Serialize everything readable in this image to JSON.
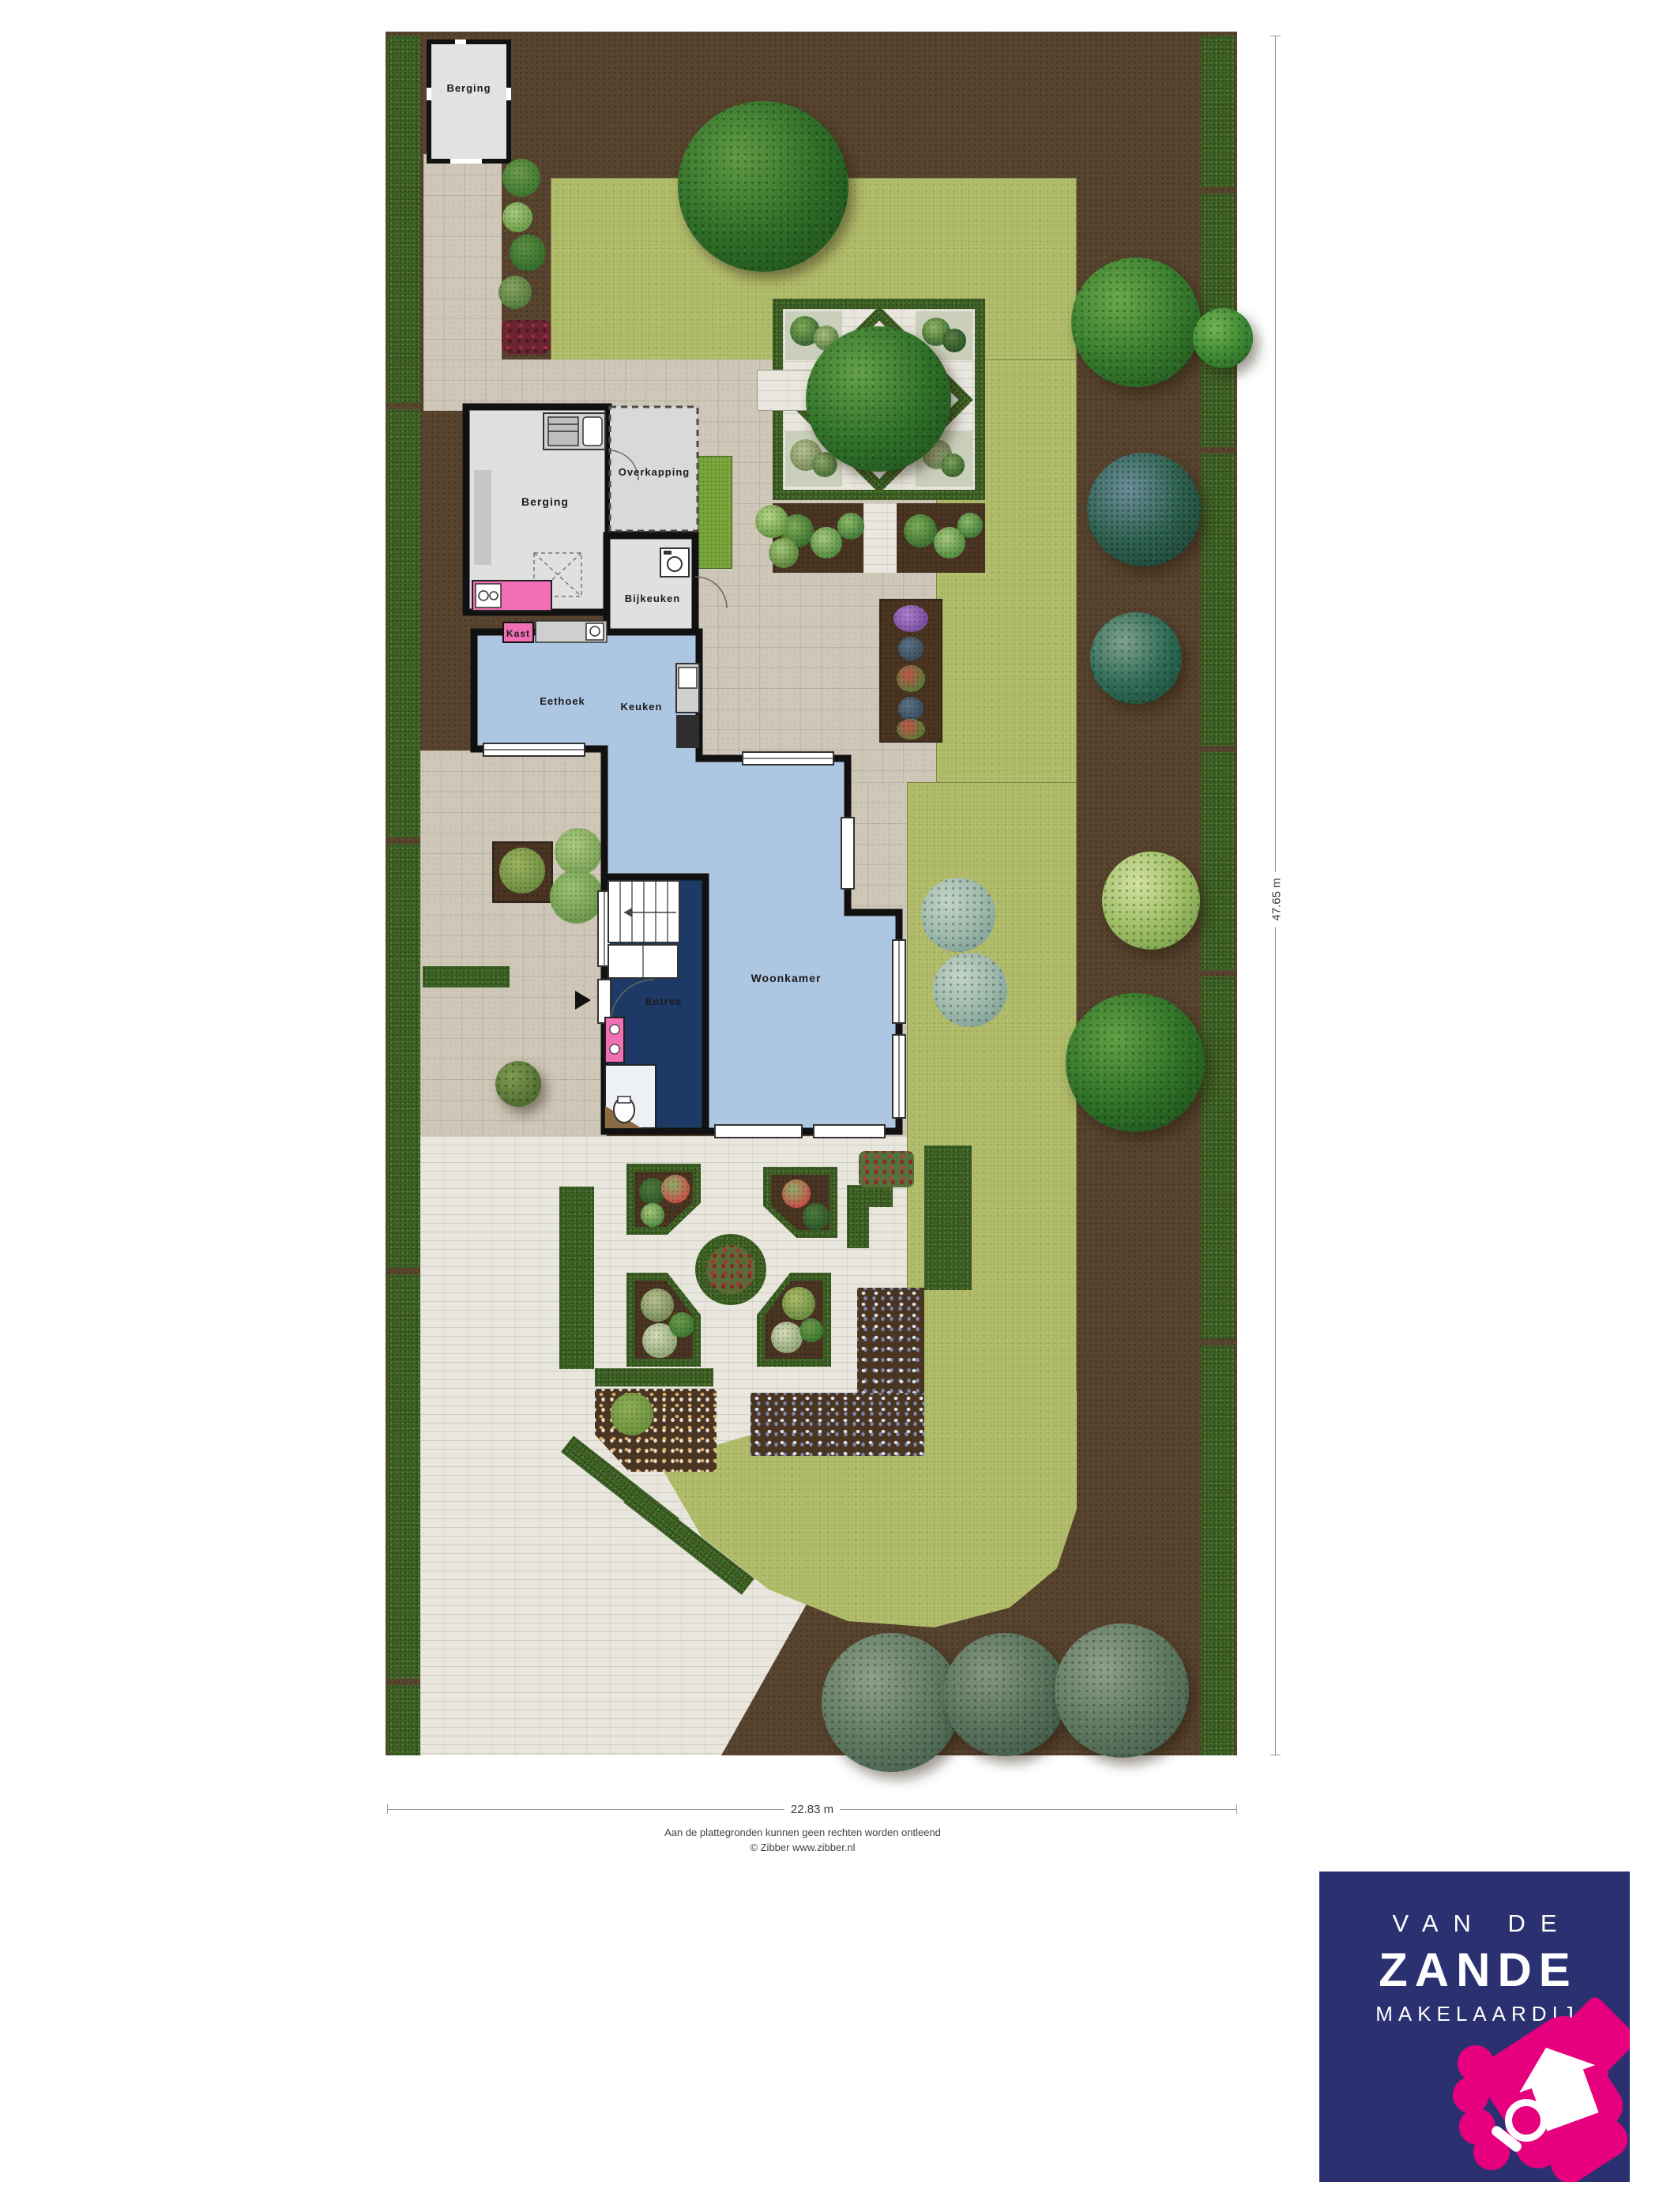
{
  "plan": {
    "labels": {
      "shed": "Berging",
      "garage": "Berging",
      "carport": "Overkapping",
      "scullery": "Bijkeuken",
      "closet": "Kast",
      "dining_nook": "Eethoek",
      "kitchen": "Keuken",
      "living_room": "Woonkamer",
      "entry": "Entree"
    },
    "dimensions": {
      "width": "22.83 m",
      "depth": "47.65 m"
    }
  },
  "footer": {
    "disclaimer": "Aan de plattegronden kunnen geen rechten worden ontleend",
    "credit": "© Zibber www.zibber.nl"
  },
  "logo": {
    "top": "VAN DE",
    "name": "ZANDE",
    "sub": "MAKELAARDIJ"
  },
  "colors": {
    "brand_navy": "#2b3170",
    "brand_magenta": "#e6007e",
    "soil_brown": "#57432e",
    "lawn_green": "#aeb966",
    "hedge_green": "#3e6126",
    "paving_light": "#e8e6dd",
    "paving_beige": "#cfc8b9",
    "room_blue": "#adc6e2",
    "entry_navy": "#1d3a66",
    "accent_pink": "#f36fb5"
  }
}
